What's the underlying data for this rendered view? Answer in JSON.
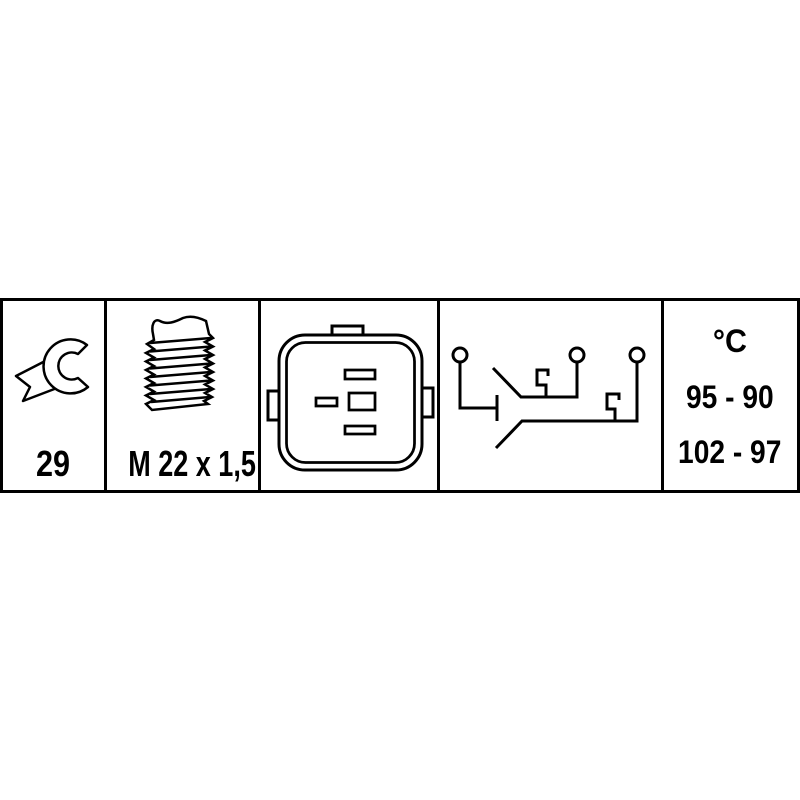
{
  "spec_table": {
    "wrench": {
      "size_label": "29"
    },
    "thread": {
      "spec_label": "M 22 x 1,5"
    },
    "temperature": {
      "unit_label": "°C",
      "switch_range_primary": "95 - 90",
      "switch_range_secondary": "102 - 97"
    },
    "icons": [
      {
        "name": "wrench-icon"
      },
      {
        "name": "thread-icon"
      },
      {
        "name": "connector-icon"
      },
      {
        "name": "circuit-icon"
      }
    ],
    "colors": {
      "line": "#000000",
      "background": "#ffffff"
    }
  }
}
